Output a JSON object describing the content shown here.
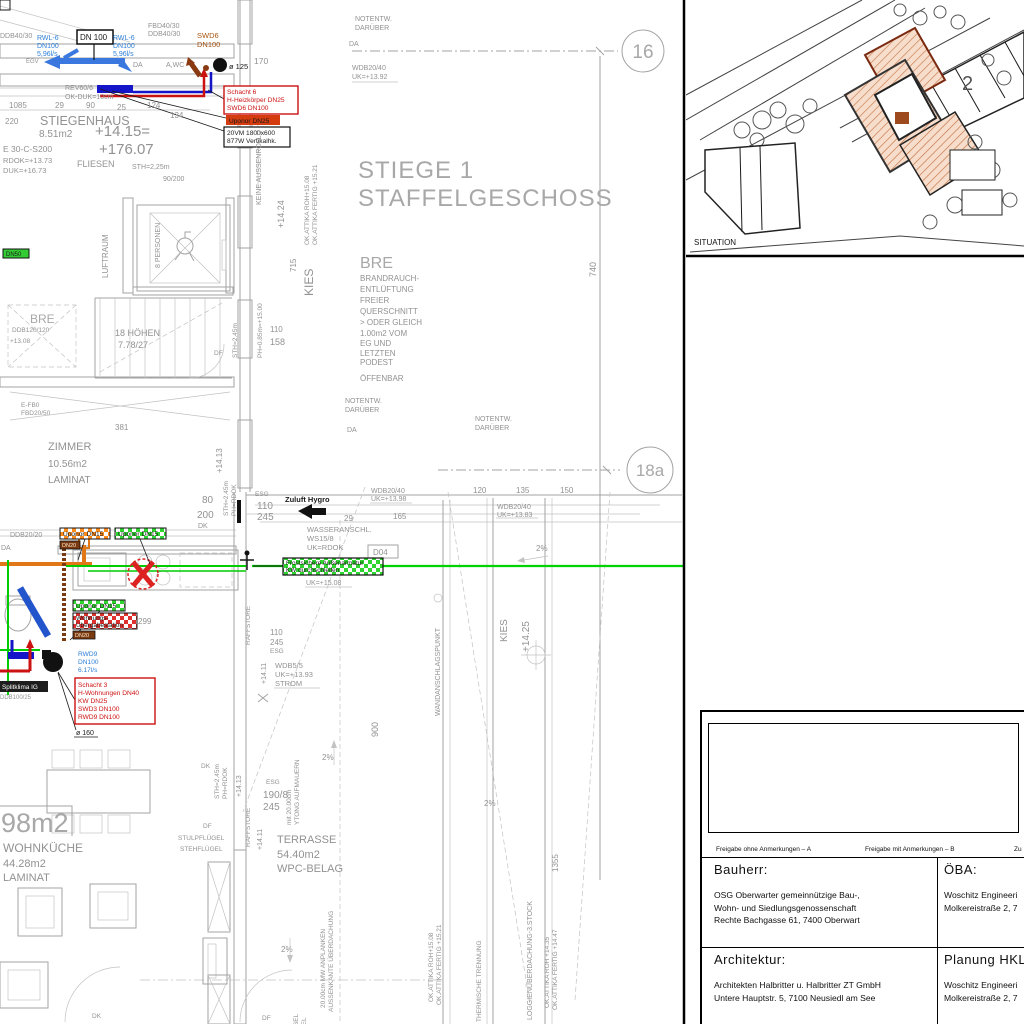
{
  "plan": {
    "pipes_top": {
      "ddb40_left": "DDB40/30",
      "rwl6": [
        "RWL-6",
        "DN100",
        "5,96l/s"
      ],
      "dn100_box": "DN 100",
      "fbd40": "FBD40/30",
      "ddb40": "DDB40/30",
      "swd6": [
        "SWD6",
        "DN100"
      ],
      "egv": "EGV",
      "da": "DA",
      "awc": "A,WC",
      "dia125": "ø 125",
      "n170": "170",
      "rev60": "REV60/6",
      "okduk": "OK-DUK=10cm",
      "schacht6": [
        "Schacht 6",
        "H-Heizkörper DN25",
        "SWD6 DN100"
      ],
      "uponor25": "Uponor DN25",
      "vm20": [
        "20VM 1800x600",
        "877W Vertikalhk."
      ]
    },
    "stiegenhaus": {
      "dims": [
        "1085",
        "29",
        "90",
        "25",
        "124",
        "134",
        "220"
      ],
      "name": "STIEGENHAUS",
      "area": "8.51m2",
      "lvl": "+14.15=",
      "lvl2": "+176.07",
      "e30": "E 30-C-S200",
      "rdok": "RDOK=+13.73",
      "duk": "DUK=+16.73",
      "fliesen": "FLIESEN",
      "sth": "STH=2,25m",
      "door": "90/200",
      "hoehen": "18 HÖHEN",
      "steigung": "7.78/27",
      "df": "DF",
      "luftraum": "LUFTRAUM",
      "personen": "8 PERSONEN",
      "bre": "BRE",
      "ddb120": "DDB120/120",
      "p1308": "+13.08",
      "dn50": "DN50"
    },
    "title": {
      "l1": "STIEGE 1",
      "l2": "STAFFELGESCHOSS"
    },
    "grid": {
      "c16": "16",
      "c18a": "18a",
      "dim740": "740"
    },
    "notentw": [
      "NOTENTW.",
      "DARÜBER"
    ],
    "wdb": {
      "w1392": [
        "WDB20/40",
        "UK=+13.92"
      ],
      "w1398": [
        "WDB20/40",
        "UK=+13.98"
      ],
      "w1383": [
        "WDB20/40",
        "UK=+13.83"
      ],
      "w55": [
        "WDB5/5",
        "UK=+13.93",
        "STROM"
      ]
    },
    "bre_note": {
      "title": "BRE",
      "lines": [
        "BRANDRAUCH-",
        "ENTLÜFTUNG",
        "FREIER",
        "QUERSCHNITT",
        "> ODER GLEICH",
        "1.00m2 VOM",
        "EG UND",
        "LETZTEN",
        "PODEST"
      ],
      "open": "ÖFFENBAR"
    },
    "attika": {
      "roh1508": "OK.ATTIKA ROH+15.08",
      "fertig1521": "OK.ATTIKA FERTIG +15.21",
      "roh1435": "OK.ATTIKA ROH +14.35",
      "fertig1447": "OK.ATTIKA FERTIG +14.47"
    },
    "side": {
      "keine": "KEINE AUSSENROLLO",
      "v1424": "+14.24",
      "v715": "715",
      "kies": "KIES",
      "n110": "110",
      "n158": "158",
      "ph085": "PH=0.85m=+15.00",
      "sth245": "STH=2.45m",
      "phrdok": "PH=RDOK",
      "v1413": "+14.13",
      "n80": "80",
      "n200": "200",
      "dk": "DK"
    },
    "zimmer": {
      "name": "ZIMMER",
      "area": "10.56m2",
      "floor": "LAMINAT",
      "n381": "381",
      "efb": "E-FB0",
      "fbd2050": "FBD20/50"
    },
    "kueche": {
      "ddb2020": "DDB20/20",
      "da": "DA",
      "uponor15": "Uponor DN15",
      "dn20": "DN20",
      "wue": [
        "Wohnungs-",
        "Übergabestation"
      ],
      "n299": "299",
      "rwd9": [
        "RWD9",
        "DN100",
        "6.17l/s"
      ],
      "schacht3": [
        "Schacht 3",
        "H-Wohnungen DN40",
        "KW DN25",
        "SWD3 DN100",
        "RWD9 DN100"
      ],
      "dia160": "ø 160",
      "splitklima": "Splitklima IG",
      "ddb10025": "DDB100/25",
      "zuluft": "Zuluft Hygro",
      "esg": "ESG",
      "n110": "110",
      "n245": "245",
      "n29": "29",
      "n165": "165",
      "wasser": [
        "WASSERANSCHL.",
        "WS15/8",
        "UK=RDOK"
      ],
      "d04": "D04",
      "frost": [
        "Frostsichere Außenarmatur",
        "KW durchschleifen"
      ],
      "uk1508": "UK=+15.08"
    },
    "terrasse": {
      "n120": "120",
      "n135": "135",
      "n150": "150",
      "pct": "2%",
      "kies": "KIES",
      "v1425": "+14.25",
      "wandpunkt": "WANDANSCHLAGSPUNKT",
      "raffstore": "RAFFSTORE",
      "v1411": "+14.11",
      "n900": "900",
      "esg190": [
        "ESG",
        "190/8",
        "245"
      ],
      "ytong": [
        "mit 20.00cm",
        "YTONG AUFMAUERN"
      ],
      "name": [
        "TERRASSE",
        "54.40m2",
        "WPC-BELAG"
      ],
      "anplanken": [
        "20.00cm MW ANPLANKEN",
        "AUSSENKANTE ÜBERDACHUNG"
      ],
      "thermisch": "THERMISCHE TRENNUNG",
      "loggia": "LOGGIENÜBERDACHUNG-3.STOCK",
      "n1355": "1355"
    },
    "wohnkueche": {
      "big": "98m2",
      "name": "WOHNKÜCHE",
      "area": "44.28m2",
      "floor": "LAMINAT",
      "dk": "DK",
      "df": "DF",
      "stulp": "STULPFLÜGEL",
      "steh": "STEHFLÜGEL"
    }
  },
  "situation": {
    "label": "SITUATION",
    "n2": "2"
  },
  "titleblock": {
    "strip": [
      "Freigabe ohne Anmerkungen – A",
      "Freigabe mit Anmerkungen – B",
      "Zu"
    ],
    "bauherr": {
      "h": "Bauherr:",
      "lines": [
        "OSG Oberwarter gemeinnützige Bau-,",
        "Wohn- und Siedlungsgenossenschaft",
        "Rechte Bachgasse 61, 7400 Oberwart"
      ]
    },
    "oeba": {
      "h": "ÖBA:",
      "lines": [
        "Woschitz Engineeri",
        "Molkereistraße 2, 7"
      ]
    },
    "arch": {
      "h": "Architektur:",
      "lines": [
        "Architekten Halbritter u. Halbritter ZT GmbH",
        "Untere Hauptstr. 5, 7100 Neusiedl am See"
      ]
    },
    "hkls": {
      "h": "Planung HKLS:",
      "lines": [
        "Woschitz Engineeri",
        "Molkereistraße 2, 7"
      ]
    }
  }
}
